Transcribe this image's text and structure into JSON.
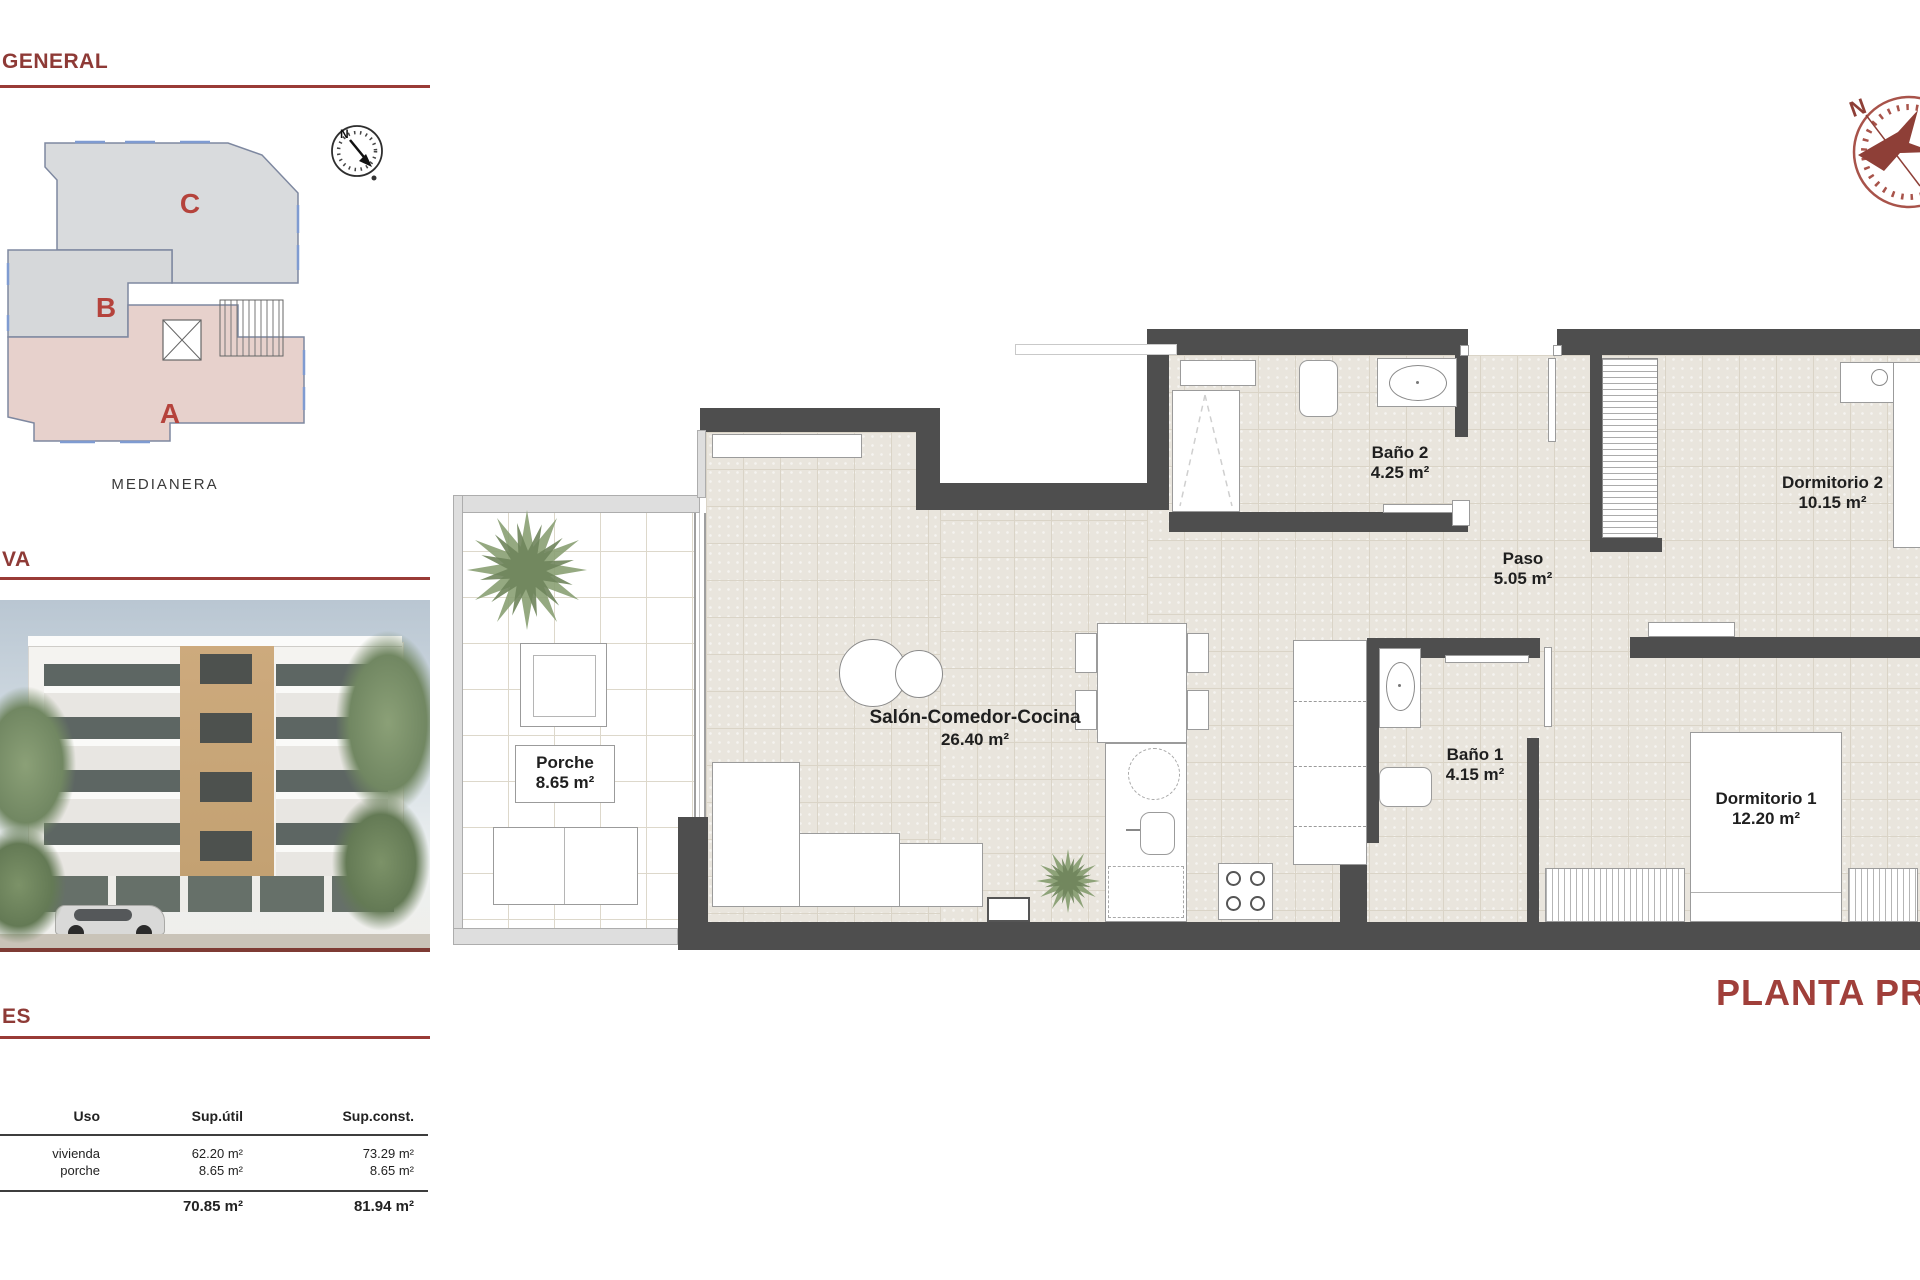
{
  "sections": {
    "general": "GENERAL",
    "perspective": "VA",
    "areas": "ES"
  },
  "site_plan": {
    "unit_a": "A",
    "unit_b": "B",
    "unit_c": "C",
    "boundary_label": "MEDIANERA",
    "compass": "N"
  },
  "areas_table": {
    "headers": [
      "Uso",
      "Sup.útil",
      "Sup.const."
    ],
    "rows": [
      {
        "uso": "vivienda",
        "util": "62.20 m²",
        "const": "73.29 m²"
      },
      {
        "uso": "porche",
        "util": "8.65 m²",
        "const": "8.65 m²"
      }
    ],
    "totals": {
      "util": "70.85 m²",
      "const": "81.94 m²"
    }
  },
  "plan": {
    "title": "PLANTA PRIMERA",
    "compass": "N",
    "rooms": {
      "porche": {
        "name": "Porche",
        "area": "8.65 m²"
      },
      "salon": {
        "name": "Salón-Comedor-Cocina",
        "area": "26.40 m²"
      },
      "bano2": {
        "name": "Baño 2",
        "area": "4.25 m²"
      },
      "paso": {
        "name": "Paso",
        "area": "5.05 m²"
      },
      "dormitorio2": {
        "name": "Dormitorio 2",
        "area": "10.15 m²"
      },
      "bano1": {
        "name": "Baño 1",
        "area": "4.15 m²"
      },
      "dormitorio1": {
        "name": "Dormitorio 1",
        "area": "12.20 m²"
      }
    }
  }
}
